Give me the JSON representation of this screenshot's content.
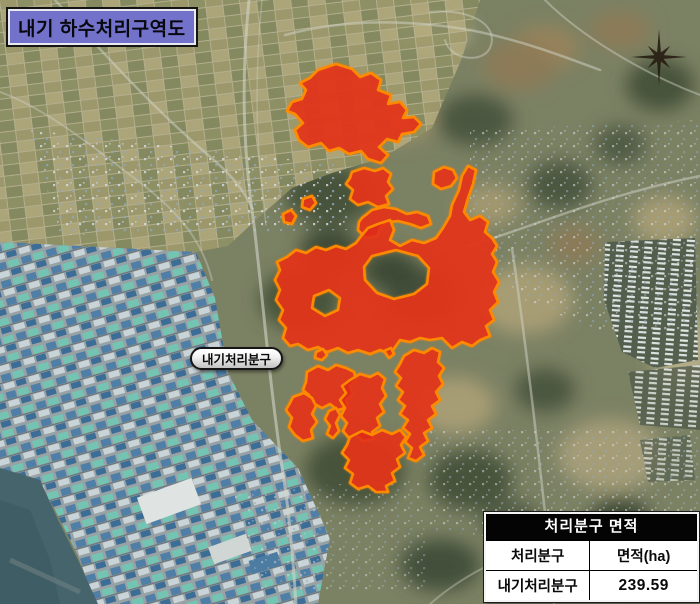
{
  "title": "내기 하수처리구역도",
  "map": {
    "district_label": "내기처리분구",
    "north_arrow_icon": "compass-rose"
  },
  "area_table": {
    "title": "처리분구 면적",
    "columns": [
      "처리분구",
      "면적(ha)"
    ],
    "rows": [
      {
        "district": "내기처리분구",
        "area_ha": "239.59"
      }
    ]
  },
  "colors": {
    "zone_fill": "#df2c1c",
    "zone_border": "#ff8a00",
    "title_box_bg": "#7372ca",
    "sea": "#45646c",
    "table_header_bg": "#000000",
    "table_header_text": "#ffffff"
  }
}
